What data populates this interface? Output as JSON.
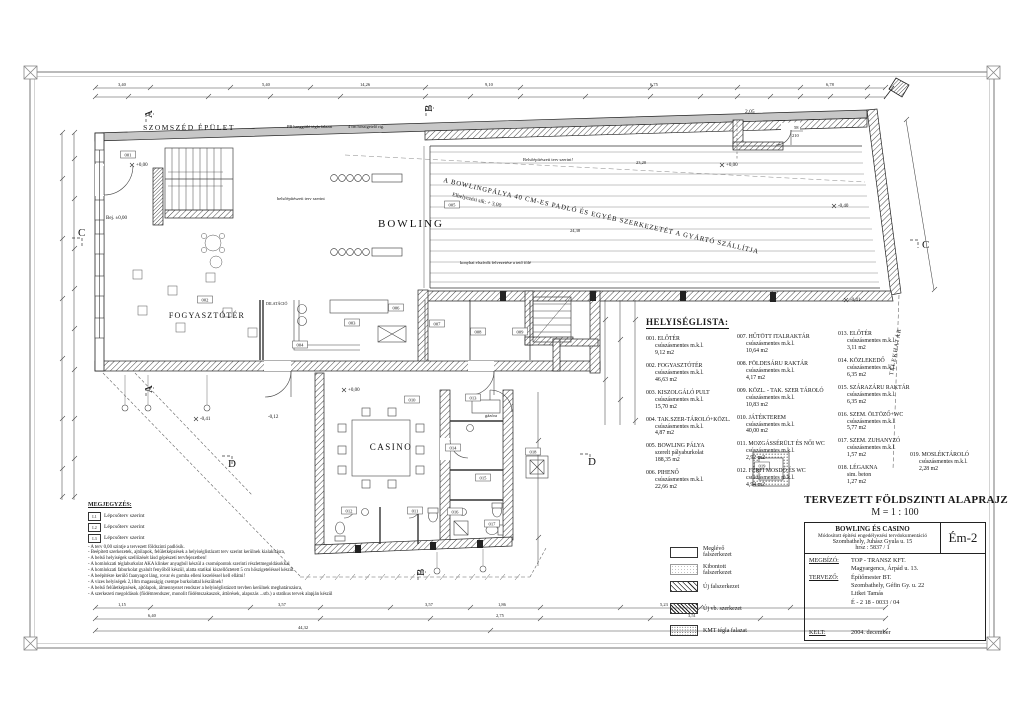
{
  "sheet": {
    "title": "TERVEZETT FÖLDSZINTI ALAPRAJZ",
    "scale": "M = 1 : 100"
  },
  "title_block": {
    "project": "BOWLING ÉS CASINO",
    "doc_type": "Módosított építési engedélyezési tervdokumentáció",
    "address": "Szombathely, Juhász Gyula u. 15",
    "parcel": "hrsz : 5837 / 1",
    "drawing_no": "Ém-2",
    "client_label": "MEGBÍZÓ:",
    "client_name": "TOP - TRANSZ KFT.",
    "client_address": "Magyargencs, Árpád u. 13.",
    "designer_label": "TERVEZŐ:",
    "designer_name": "Építőmester  BT.",
    "designer_address": "Szombathely, Géfin Gy. u. 22",
    "designer_person": "Litkei  Tamás",
    "designer_reg": "É - 2  18 - 0033 / 04",
    "date_label": "KELT:",
    "date": "2004. december"
  },
  "room_list": {
    "heading": "HELYISÉGLISTA:",
    "items": [
      {
        "code": "001.",
        "name": "ELŐTÉR",
        "finish": "csúszásmentes m.k.l.",
        "area": "9,12 m2"
      },
      {
        "code": "002.",
        "name": "FOGYASZTÓTÉR",
        "finish": "csúszásmentes m.k.l.",
        "area": "46,63 m2"
      },
      {
        "code": "003.",
        "name": "KISZOLGÁLÓ PULT",
        "finish": "csúszásmentes m.k.l.",
        "area": "15,70 m2"
      },
      {
        "code": "004.",
        "name": "TAK.SZER-TÁROLÓ+KÖZL.",
        "finish": "csúszásmentes m.k.l.",
        "area": "4,87 m2"
      },
      {
        "code": "005.",
        "name": "BOWLING PÁLYA",
        "finish": "szerelt pályaburkolat",
        "area": "188,35 m2"
      },
      {
        "code": "006.",
        "name": "PIHENŐ",
        "finish": "csúszásmentes m.k.l.",
        "area": "22,66 m2"
      },
      {
        "code": "007.",
        "name": "HŰTÖTT ITALRAKTÁR",
        "finish": "csúszásmentes m.k.l.",
        "area": "10,64 m2"
      },
      {
        "code": "008.",
        "name": "FÖLDESÁRU RAKTÁR",
        "finish": "csúszásmentes m.k.l.",
        "area": "4,17 m2"
      },
      {
        "code": "009.",
        "name": "KÖZL. - TAK. SZER TÁROLÓ",
        "finish": "csúszásmentes m.k.l.",
        "area": "10,83 m2"
      },
      {
        "code": "010.",
        "name": "JÁTÉKTEREM",
        "finish": "csúszásmentes m.k.l.",
        "area": "40,00 m2"
      },
      {
        "code": "011.",
        "name": "MOZGÁSSÉRÜLT ÉS NŐI WC",
        "finish": "csúszásmentes m.k.l.",
        "area": "2,92 m2"
      },
      {
        "code": "012.",
        "name": "FÉRFI MOSDÓ ÉS WC",
        "finish": "csúszásmentes m.k.l.",
        "area": "4,94 m2"
      },
      {
        "code": "013.",
        "name": "ELŐTÉR",
        "finish": "csúszásmentes m.k.l.",
        "area": "3,11 m2"
      },
      {
        "code": "014.",
        "name": "KÖZLEKEDŐ",
        "finish": "csúszásmentes m.k.l.",
        "area": "6,35 m2"
      },
      {
        "code": "015.",
        "name": "SZÁRAZÁRU RAKTÁR",
        "finish": "csúszásmentes m.k.l.",
        "area": "6,35 m2"
      },
      {
        "code": "016.",
        "name": "SZEM. ÖLTÖZŐ+WC",
        "finish": "csúszásmentes m.k.l.",
        "area": "5,77 m2"
      },
      {
        "code": "017.",
        "name": "SZEM. ZUHANYZÓ",
        "finish": "csúszásmentes m.k.l.",
        "area": "1,57 m2"
      },
      {
        "code": "018.",
        "name": "LÉGAKNA",
        "finish": "sim. beton",
        "area": "1,27 m2"
      },
      {
        "code": "019.",
        "name": "MOSLÉKTÁROLÓ",
        "finish": "csúszásmentes m.k.l.",
        "area": "2,28 m2"
      }
    ]
  },
  "legend": {
    "items": [
      {
        "label": "Meglévő falszerkezet"
      },
      {
        "label": "Kibontott falszerkezet"
      },
      {
        "label": "Új  falszerkezet"
      },
      {
        "label": "Új  vb. szerkezet"
      },
      {
        "label": "KMT tégla falazat"
      }
    ]
  },
  "notes": {
    "heading": "MEGJEGYZÉS:",
    "stair_items": [
      {
        "code": "L1",
        "text": "Lépcsőterv szerint"
      },
      {
        "code": "L2",
        "text": "Lépcsőterv szerint"
      },
      {
        "code": "L3",
        "text": "Lépcsőterv szerint"
      }
    ],
    "lines": [
      "- A terv 0,00 szintje a tervezett földszinti padlósík.",
      "- Beépített szerkezetek, ajtólapok, felületképzések a helyiséglistázott terv szerint kerülnek kialakításra,",
      "- A belső helyiségek szellőzését lásd gépészeti tervfejezetben!",
      "- A homlokzati téglaburkolat AKA klinker anyagból készül a csomópontok szerinti részletmegoldásokkal",
      "- A homlokzati faburkolat gyalult fenyőből készül, alatta statikai kiszellőztetett 5 cm hőszigeteléssel készül.",
      "- A beépítésre kerülő faanyagot láng, rovar és gomba elleni kezeléssel kell ellátni!",
      "- A vizes helyiségek 2,10m magasságig csempe burkolattal készülnek!",
      "- A belső felületképzések, ajtólapok, álmennyezet rendszer a helyiséglistázott tervben kerülnek meghatározásra,",
      "- A szerkezeti megoldások (födémrendszer, monolit födémszakaszok, áttörések, alapozás ...stb.) a statikus tervek alapján készül"
    ]
  },
  "plan": {
    "labels": {
      "szomszed": "SZOMSZÉD ÉPÜLET",
      "bowling": "BOWLING",
      "fogyaszto": "FOGYASZTÓTÉR",
      "casino": "CASINO",
      "diag1": "A BOWLINGPÁLYA 40 CM-ES PADLÓ ÉS EGYÉB SZERKEZETÉT A GYÁRTÓ SZÁLLÍTJA",
      "diag2": "Elhelyezési sík: + 3,00",
      "belso_top": "Belsőépítészeti terv szerint!",
      "belso_left": "belsőépítészeti terv szerint",
      "pb": "PB hanggátló tégla falazat",
      "pb2": "4 cm hőszigetelő rtg.",
      "konyha": "konyhai elszívók felvezetése a tető fölé",
      "gazora": "gázóra",
      "dilatacio": "DILATÁCIÓ",
      "telekhatar": "TELEKHATÁR"
    },
    "levels": [
      "+0,00",
      "Bej. ±0,00",
      "+0,00",
      "+0,00",
      "-0,40",
      "-0,41",
      "-0,41",
      "-0,12"
    ],
    "dims": {
      "top": [
        "3,40",
        "5,40",
        "14,26",
        "9,10",
        "6,75",
        "6,78"
      ],
      "notch": "2,05",
      "door58_a": "58",
      "door58_b": "210",
      "inner": [
        "24,38",
        "23,20"
      ],
      "bottom": [
        "1,15",
        "3,57",
        "3,57",
        "1,86",
        "5,23",
        "6,40",
        "2,75",
        "3,51",
        "44,32"
      ]
    },
    "sections": [
      "A",
      "A",
      "B",
      "B",
      "C",
      "C",
      "D",
      "D"
    ],
    "room_tags": [
      "001",
      "002",
      "003",
      "004",
      "005",
      "006",
      "007",
      "008",
      "009",
      "010",
      "011",
      "012",
      "013",
      "014",
      "015",
      "016",
      "017",
      "018",
      "019"
    ]
  }
}
